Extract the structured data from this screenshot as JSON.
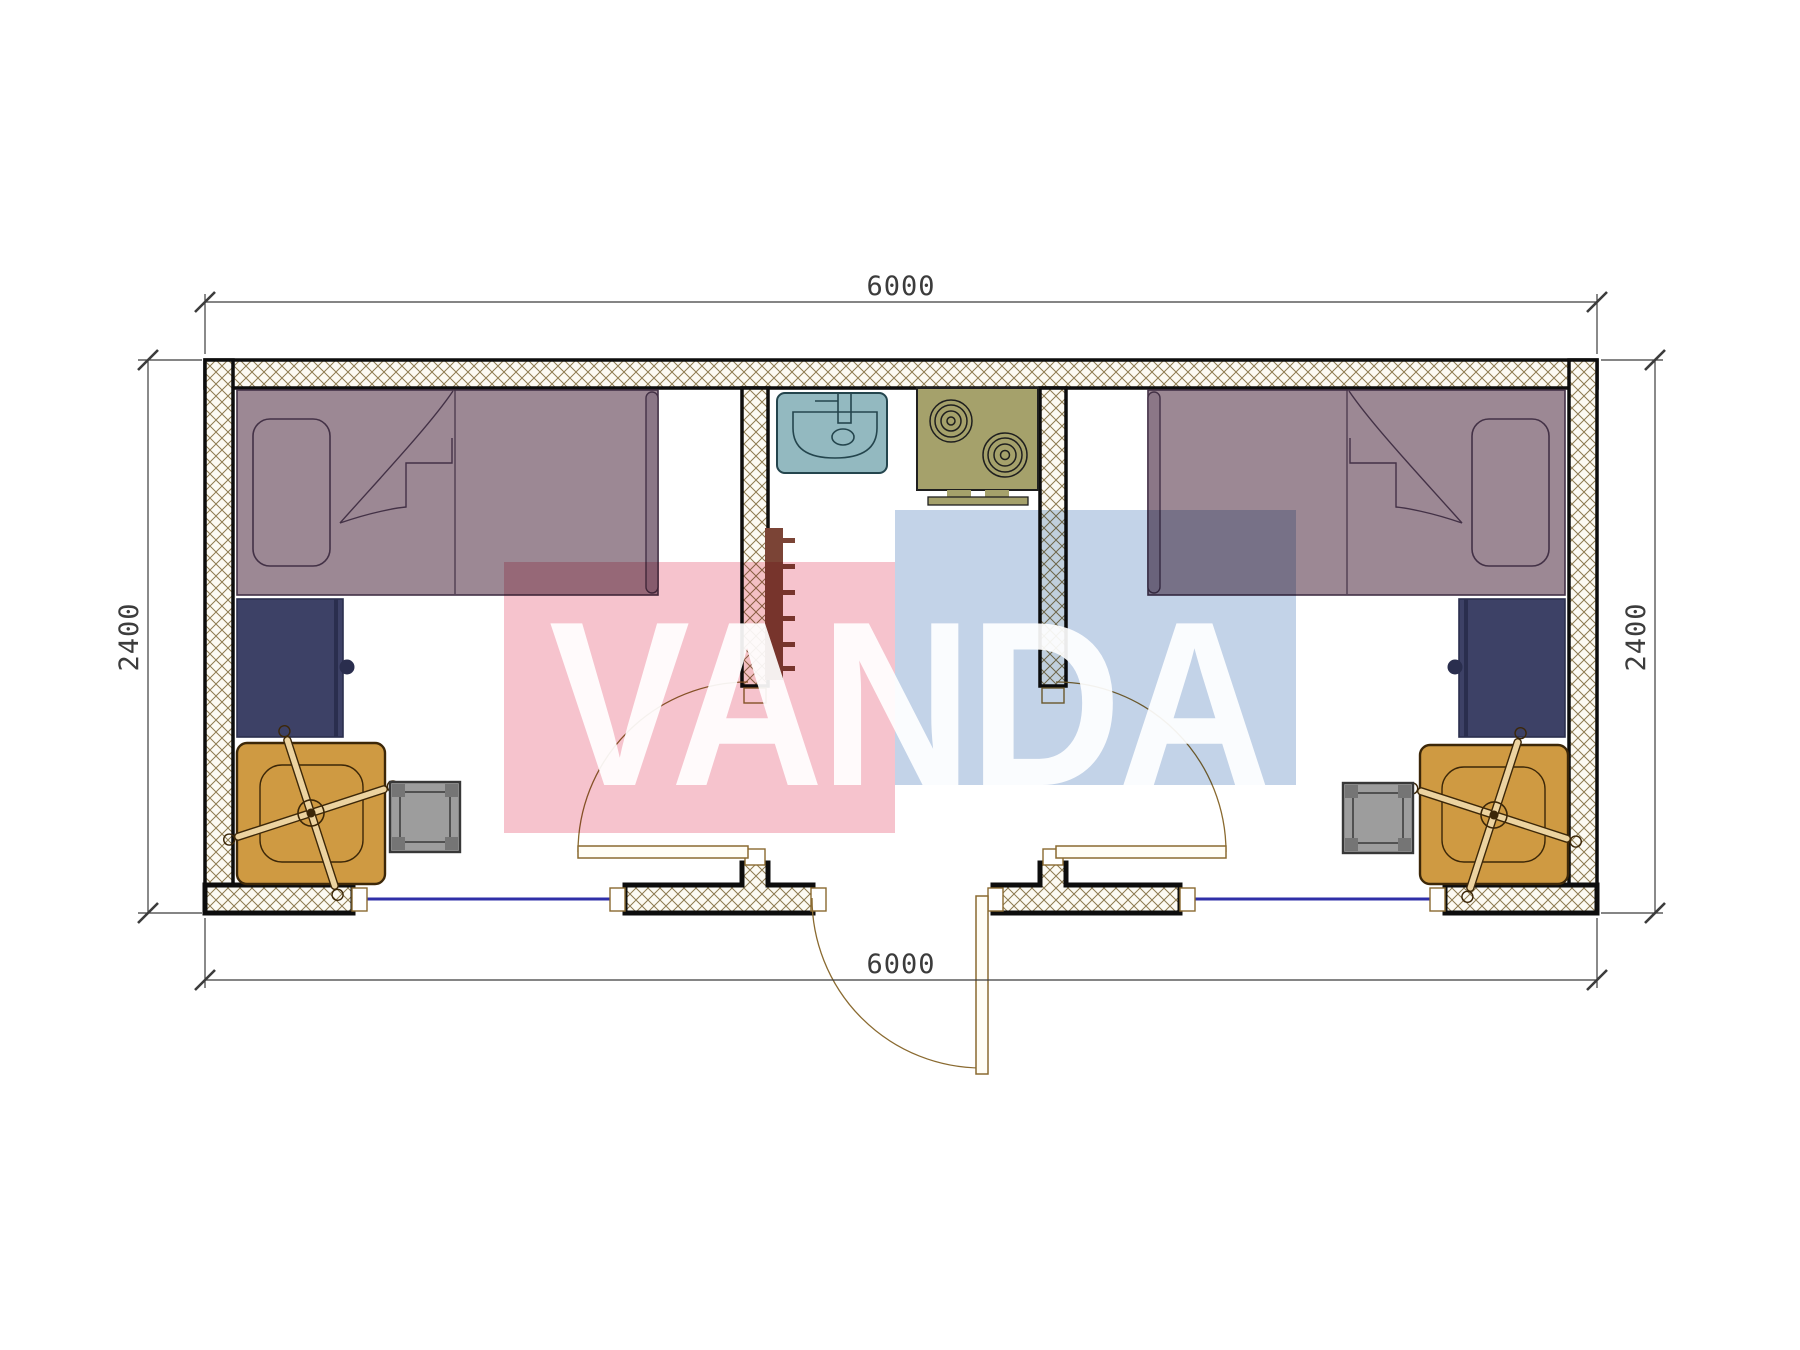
{
  "plan": {
    "type": "floor-plan",
    "unit_hint": "mm",
    "dimensions": {
      "top": "6000",
      "bottom": "6000",
      "left": "2400",
      "right": "2400"
    },
    "watermark": {
      "text": "VANDA"
    },
    "furniture": [
      {
        "name": "single-bed-left"
      },
      {
        "name": "single-bed-right"
      },
      {
        "name": "desk-left"
      },
      {
        "name": "desk-right"
      },
      {
        "name": "office-chair-left"
      },
      {
        "name": "office-chair-right"
      },
      {
        "name": "stool-left"
      },
      {
        "name": "stool-right"
      },
      {
        "name": "sink"
      },
      {
        "name": "two-burner-stove"
      },
      {
        "name": "radiator"
      },
      {
        "name": "interior-door-left"
      },
      {
        "name": "interior-door-right"
      },
      {
        "name": "entry-door"
      },
      {
        "name": "window-left"
      },
      {
        "name": "window-right"
      }
    ],
    "colors": {
      "floor": "#ffffff",
      "hatchLine": "#8d7a50",
      "hatchBg": "#fcfaf3",
      "wallStroke": "#0d0d0d",
      "bed": "#9c8894",
      "bedTrim": "#8b7787",
      "bedLine": "#433146",
      "desk": "#3d4166",
      "deskEdge": "#2a2e4e",
      "chair": "#cf9a42",
      "chairDetail": "#3c2708",
      "chairLight": "#ecd3a0",
      "stool": "#9d9d9d",
      "stoolPost": "#757575",
      "stoolStroke": "#383838",
      "sink": "#93b9c0",
      "sinkLine": "#24454d",
      "stove": "#a5a16b",
      "stoveLine": "#1f1f1f",
      "radiator": "#7b4436",
      "windowLine": "#2f2fa8",
      "dimLine": "#3c3c3c",
      "doorLine": "#8a6a30",
      "doorFill": "#fffdf5",
      "watermarkPink": "#f5bdc8",
      "watermarkBlue": "#bdcee5",
      "watermarkText": "#ffffff"
    }
  }
}
